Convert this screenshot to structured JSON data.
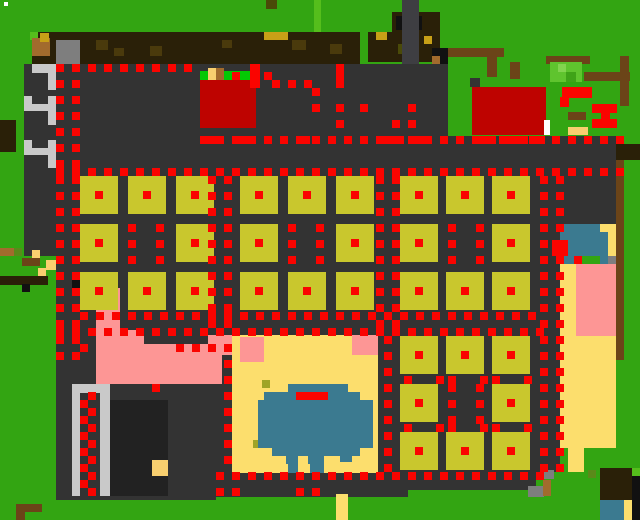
{
  "map": {
    "meta": {
      "width": 640,
      "height": 520,
      "background": "G",
      "dot_size": 8
    },
    "palette": {
      "G": "#33A512",
      "g": "#55BE1C",
      "E": "#04C804",
      "bu": "#5FC42E",
      "bl": "#82D44F",
      "bd": "#3FA318",
      "o2": "#5A8A1A",
      "D": "#333333",
      "D2": "#3E3E42",
      "K2": "#222222",
      "K": "#111111",
      "L": "#C9C9C9",
      "M": "#7E7E7E",
      "R": "#FA0400",
      "r": "#BE0300",
      "P": "#FD9695",
      "S": "#FCDE6D",
      "Y": "#F8CF6F",
      "T": "#C8A017",
      "O": "#C9C72D",
      "o": "#9FA426",
      "W": "#3B7A90",
      "B": "#2A2008",
      "b": "#6B4418",
      "t": "#A26B2D",
      "dk": "#4A3A0C",
      "do": "#4A4A08",
      "w": "#FFFFFF"
    },
    "rects": [
      [
        "w",
        4,
        2,
        4,
        4
      ],
      [
        "B",
        32,
        32,
        328,
        32
      ],
      [
        "g",
        30,
        32,
        8,
        8
      ],
      [
        "t",
        32,
        38,
        18,
        18
      ],
      [
        "T",
        40,
        33,
        9,
        9
      ],
      [
        "M",
        56,
        40,
        24,
        24
      ],
      [
        "dk",
        96,
        40,
        12,
        10
      ],
      [
        "dk",
        114,
        48,
        10,
        8
      ],
      [
        "dk",
        150,
        46,
        12,
        10
      ],
      [
        "dk",
        222,
        40,
        10,
        8
      ],
      [
        "T",
        264,
        32,
        24,
        8
      ],
      [
        "dk",
        292,
        40,
        14,
        10
      ],
      [
        "dk",
        330,
        44,
        12,
        10
      ],
      [
        "do",
        266,
        0,
        11,
        9
      ],
      [
        "g",
        314,
        0,
        7,
        32
      ],
      [
        "B",
        368,
        32,
        72,
        30
      ],
      [
        "B",
        392,
        12,
        48,
        20
      ],
      [
        "K",
        396,
        16,
        26,
        14
      ],
      [
        "T",
        376,
        32,
        11,
        8
      ],
      [
        "do",
        398,
        44,
        10,
        10
      ],
      [
        "T",
        424,
        36,
        8,
        8
      ],
      [
        "D2",
        402,
        0,
        17,
        80
      ],
      [
        "b",
        440,
        48,
        64,
        9
      ],
      [
        "b",
        487,
        57,
        10,
        20
      ],
      [
        "b",
        510,
        62,
        10,
        17
      ],
      [
        "b",
        546,
        56,
        44,
        8
      ],
      [
        "b",
        584,
        72,
        46,
        9
      ],
      [
        "b",
        620,
        56,
        9,
        50
      ],
      [
        "K",
        432,
        48,
        16,
        16
      ],
      [
        "t",
        432,
        56,
        8,
        8
      ],
      [
        "D",
        424,
        64,
        24,
        72
      ],
      [
        "D",
        470,
        78,
        10,
        9
      ],
      [
        "bu",
        550,
        62,
        32,
        20
      ],
      [
        "bl",
        558,
        64,
        8,
        8
      ],
      [
        "bd",
        566,
        72,
        10,
        10
      ],
      [
        "r",
        472,
        87,
        74,
        48
      ],
      [
        "w",
        544,
        120,
        6,
        15
      ],
      [
        "R",
        562,
        87,
        30,
        11
      ],
      [
        "R",
        560,
        97,
        9,
        10
      ],
      [
        "R",
        592,
        104,
        25,
        9
      ],
      [
        "R",
        601,
        112,
        9,
        9
      ],
      [
        "R",
        592,
        119,
        25,
        9
      ],
      [
        "b",
        568,
        112,
        18,
        8
      ],
      [
        "Y",
        568,
        127,
        20,
        8
      ],
      [
        "D",
        24,
        64,
        400,
        104
      ],
      [
        "D",
        424,
        136,
        192,
        32
      ],
      [
        "E",
        200,
        71,
        50,
        9
      ],
      [
        "Y",
        208,
        68,
        8,
        12
      ],
      [
        "t",
        216,
        68,
        8,
        12
      ],
      [
        "r",
        200,
        80,
        56,
        48
      ],
      [
        "R",
        250,
        64,
        10,
        24
      ],
      [
        "R",
        336,
        64,
        8,
        24
      ],
      [
        "L",
        32,
        64,
        24,
        9
      ],
      [
        "L",
        48,
        64,
        8,
        26
      ],
      [
        "L",
        24,
        96,
        8,
        12
      ],
      [
        "L",
        48,
        96,
        8,
        12
      ],
      [
        "L",
        24,
        104,
        32,
        7
      ],
      [
        "L",
        48,
        111,
        8,
        14
      ],
      [
        "L",
        24,
        140,
        8,
        12
      ],
      [
        "L",
        48,
        140,
        8,
        12
      ],
      [
        "L",
        24,
        148,
        32,
        7
      ],
      [
        "L",
        48,
        155,
        8,
        14
      ],
      [
        "L",
        24,
        186,
        8,
        12
      ],
      [
        "L",
        48,
        186,
        8,
        12
      ],
      [
        "L",
        24,
        194,
        32,
        7
      ],
      [
        "L",
        48,
        201,
        8,
        14
      ],
      [
        "L",
        24,
        232,
        8,
        10
      ],
      [
        "L",
        48,
        232,
        8,
        16
      ],
      [
        "L",
        24,
        244,
        32,
        10
      ],
      [
        "B",
        0,
        120,
        16,
        32
      ],
      [
        "D",
        24,
        168,
        536,
        168
      ],
      [
        "D",
        536,
        168,
        24,
        304
      ],
      [
        "D",
        544,
        168,
        72,
        56
      ],
      [
        "G",
        0,
        256,
        56,
        264
      ],
      [
        "D",
        56,
        248,
        160,
        252
      ],
      [
        "D",
        208,
        336,
        200,
        161
      ],
      [
        "D",
        392,
        336,
        144,
        154
      ],
      [
        "K2",
        104,
        400,
        64,
        96
      ],
      [
        "Y",
        152,
        460,
        16,
        16
      ],
      [
        "L",
        72,
        384,
        8,
        112
      ],
      [
        "L",
        100,
        384,
        10,
        112
      ],
      [
        "L",
        72,
        384,
        38,
        9
      ],
      [
        "P",
        96,
        288,
        24,
        48
      ],
      [
        "P",
        96,
        330,
        48,
        54
      ],
      [
        "P",
        144,
        344,
        78,
        40
      ],
      [
        "P",
        208,
        335,
        24,
        20
      ],
      [
        "S",
        232,
        335,
        146,
        138
      ],
      [
        "P",
        240,
        337,
        24,
        25
      ],
      [
        "P",
        352,
        335,
        26,
        20
      ],
      [
        "o",
        262,
        380,
        8,
        8
      ],
      [
        "o",
        253,
        440,
        8,
        8
      ],
      [
        "W",
        288,
        384,
        60,
        8
      ],
      [
        "W",
        264,
        392,
        96,
        8
      ],
      [
        "W",
        258,
        400,
        115,
        48
      ],
      [
        "W",
        272,
        448,
        88,
        8
      ],
      [
        "W",
        286,
        456,
        12,
        8
      ],
      [
        "W",
        308,
        456,
        16,
        8
      ],
      [
        "W",
        340,
        452,
        12,
        10
      ],
      [
        "W",
        288,
        464,
        10,
        9
      ],
      [
        "W",
        310,
        464,
        14,
        9
      ],
      [
        "R",
        296,
        392,
        32,
        8
      ],
      [
        "W",
        560,
        224,
        48,
        32
      ],
      [
        "S",
        600,
        224,
        16,
        8
      ],
      [
        "S",
        608,
        232,
        8,
        32
      ],
      [
        "W",
        560,
        256,
        16,
        8
      ],
      [
        "W",
        600,
        256,
        8,
        8
      ],
      [
        "M",
        608,
        256,
        8,
        8
      ],
      [
        "S",
        560,
        264,
        16,
        72
      ],
      [
        "P",
        576,
        264,
        40,
        128
      ],
      [
        "S",
        560,
        336,
        56,
        112
      ],
      [
        "S",
        568,
        448,
        16,
        24
      ],
      [
        "R",
        552,
        240,
        16,
        16
      ],
      [
        "b",
        616,
        144,
        8,
        216
      ],
      [
        "B",
        616,
        144,
        24,
        16
      ],
      [
        "B",
        600,
        468,
        40,
        32
      ],
      [
        "g",
        632,
        468,
        8,
        8
      ],
      [
        "K",
        632,
        476,
        8,
        22
      ],
      [
        "o2",
        588,
        470,
        8,
        8
      ],
      [
        "W",
        600,
        500,
        24,
        20
      ],
      [
        "S",
        624,
        500,
        8,
        20
      ],
      [
        "K",
        632,
        498,
        8,
        22
      ],
      [
        "M",
        544,
        470,
        10,
        9
      ],
      [
        "M",
        528,
        486,
        16,
        11
      ],
      [
        "t",
        543,
        480,
        8,
        16
      ],
      [
        "S",
        336,
        494,
        12,
        26
      ],
      [
        "b",
        16,
        504,
        26,
        8
      ],
      [
        "b",
        16,
        512,
        9,
        8
      ],
      [
        "t",
        0,
        248,
        14,
        8
      ],
      [
        "o2",
        14,
        248,
        8,
        8
      ],
      [
        "Y",
        32,
        250,
        8,
        8
      ],
      [
        "b",
        22,
        258,
        18,
        8
      ],
      [
        "Y",
        46,
        260,
        10,
        10
      ],
      [
        "Y",
        38,
        268,
        8,
        8
      ],
      [
        "B",
        0,
        276,
        48,
        9
      ],
      [
        "K",
        22,
        284,
        8,
        8
      ],
      [
        "K",
        72,
        276,
        8,
        18
      ],
      [
        "R",
        200,
        136,
        22,
        8
      ],
      [
        "R",
        232,
        136,
        16,
        8
      ],
      [
        "R",
        296,
        136,
        14,
        8
      ],
      [
        "R",
        384,
        136,
        20,
        8
      ],
      [
        "R",
        408,
        136,
        18,
        8
      ],
      [
        "R",
        472,
        136,
        21,
        8
      ],
      [
        "R",
        499,
        136,
        24,
        8
      ],
      [
        "R",
        529,
        136,
        16,
        8
      ]
    ],
    "plots": {
      "color": "O",
      "center_color": "R",
      "size": 38,
      "center_offset": 15,
      "center_size": 8,
      "cols": [
        80,
        128,
        176,
        240,
        288,
        336,
        400,
        446,
        492
      ],
      "rows": [
        176,
        224,
        272,
        336,
        384,
        432
      ],
      "blocks": [
        {
          "row_range": [
            0,
            2
          ],
          "col_range": [
            0,
            8
          ]
        },
        {
          "row_range": [
            3,
            5
          ],
          "col_range": [
            6,
            8
          ]
        }
      ],
      "missing": [
        [
          1,
          1
        ],
        [
          1,
          4
        ],
        [
          1,
          7
        ],
        [
          4,
          7
        ]
      ]
    },
    "dot_runs": [
      [
        56,
        64,
        19,
        0,
        16
      ],
      [
        72,
        80,
        18,
        0,
        16
      ],
      [
        208,
        176,
        10,
        0,
        16
      ],
      [
        224,
        176,
        10,
        0,
        16
      ],
      [
        376,
        176,
        10,
        0,
        16
      ],
      [
        392,
        176,
        10,
        0,
        16
      ],
      [
        540,
        176,
        19,
        0,
        16
      ],
      [
        556,
        176,
        19,
        0,
        16
      ],
      [
        384,
        336,
        9,
        0,
        16
      ],
      [
        224,
        344,
        8,
        0,
        16
      ],
      [
        80,
        400,
        6,
        0,
        16
      ],
      [
        88,
        392,
        7,
        0,
        16
      ],
      [
        56,
        64,
        9,
        16,
        0
      ],
      [
        200,
        136,
        27,
        16,
        0
      ],
      [
        56,
        168,
        36,
        16,
        0
      ],
      [
        80,
        312,
        29,
        16,
        0
      ],
      [
        56,
        328,
        31,
        16,
        0
      ],
      [
        216,
        472,
        21,
        16,
        0
      ],
      [
        128,
        224,
        3,
        0,
        16
      ],
      [
        156,
        224,
        3,
        0,
        16
      ],
      [
        288,
        224,
        3,
        0,
        16
      ],
      [
        316,
        224,
        3,
        0,
        16
      ],
      [
        448,
        224,
        3,
        0,
        16
      ],
      [
        476,
        224,
        3,
        0,
        16
      ],
      [
        448,
        384,
        3,
        0,
        16
      ],
      [
        476,
        384,
        3,
        0,
        16
      ]
    ],
    "dot_singles": [
      [
        232,
        72
      ],
      [
        264,
        72
      ],
      [
        272,
        80
      ],
      [
        288,
        80
      ],
      [
        304,
        80
      ],
      [
        312,
        88
      ],
      [
        312,
        104
      ],
      [
        336,
        104
      ],
      [
        336,
        120
      ],
      [
        360,
        104
      ],
      [
        392,
        120
      ],
      [
        408,
        104
      ],
      [
        408,
        120
      ],
      [
        152,
        384
      ],
      [
        574,
        256
      ],
      [
        80,
        344
      ],
      [
        176,
        344
      ],
      [
        192,
        344
      ],
      [
        208,
        344
      ],
      [
        216,
        488
      ],
      [
        232,
        488
      ],
      [
        296,
        488
      ],
      [
        312,
        488
      ],
      [
        404,
        376
      ],
      [
        436,
        376
      ],
      [
        448,
        376
      ],
      [
        480,
        376
      ],
      [
        492,
        376
      ],
      [
        524,
        376
      ],
      [
        404,
        424
      ],
      [
        436,
        424
      ],
      [
        448,
        424
      ],
      [
        480,
        424
      ],
      [
        492,
        424
      ],
      [
        524,
        424
      ]
    ]
  }
}
